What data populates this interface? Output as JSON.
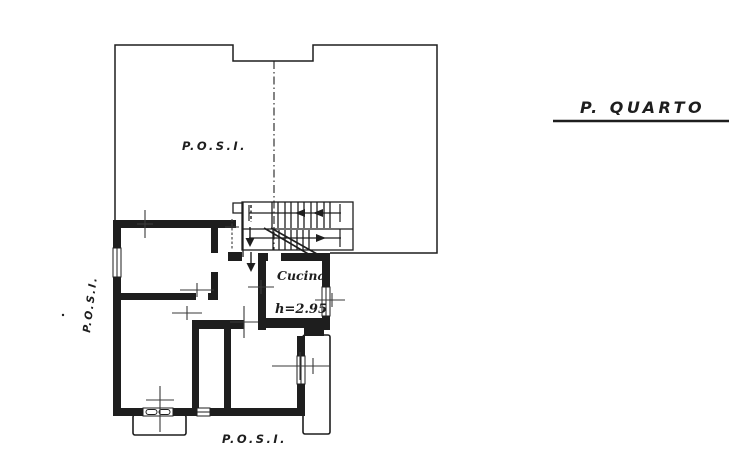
{
  "title": {
    "label": "P. QUARTO"
  },
  "labels": {
    "terrace_top": "P.O.S.I.",
    "terrace_left": "P.O.S.I.",
    "terrace_bottom": "P.O.S.I."
  },
  "rooms": {
    "kitchen": {
      "name": "Cucina",
      "height_note": "h=2.95"
    }
  },
  "colors": {
    "ink": "#1e1e1e",
    "paper": "#ffffff"
  }
}
